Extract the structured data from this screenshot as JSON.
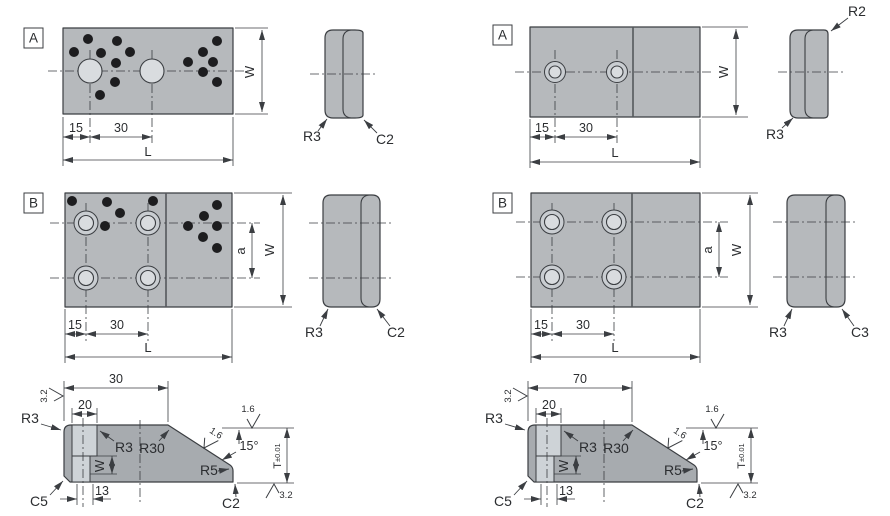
{
  "colors": {
    "paper": "#ffffff",
    "line": "#3b3e42",
    "text": "#2b2d30",
    "plate": "#b6b9bc",
    "profile": "#a7abaf",
    "slot": "#ced3d7",
    "hole": "#d9dcdf",
    "ring": "#c9cdd1",
    "dot": "#1d1d1f",
    "divider": "#55585c"
  },
  "figures": {
    "a_left": {
      "label": "A",
      "dims": {
        "d15": "15",
        "d30": "30",
        "L": "L",
        "W": "W"
      },
      "side": {
        "r3": "R3",
        "c2": "C2"
      },
      "dots": [
        [
          88,
          39
        ],
        [
          117,
          41
        ],
        [
          74,
          52
        ],
        [
          101,
          53
        ],
        [
          130,
          52
        ],
        [
          116,
          63
        ],
        [
          115,
          82
        ],
        [
          100,
          95
        ],
        [
          217,
          41
        ],
        [
          203,
          52
        ],
        [
          188,
          62
        ],
        [
          213,
          62
        ],
        [
          203,
          72
        ],
        [
          217,
          82
        ]
      ]
    },
    "a_right": {
      "label": "A",
      "dims": {
        "d15": "15",
        "d30": "30",
        "L": "L",
        "W": "W"
      },
      "side": {
        "r2": "R2",
        "r3": "R3"
      }
    },
    "b_left": {
      "label": "B",
      "dims": {
        "d15": "15",
        "d30": "30",
        "L": "L",
        "W": "W",
        "a": "a"
      },
      "side": {
        "r3": "R3",
        "c2": "C2"
      },
      "dots": [
        [
          72,
          201
        ],
        [
          107,
          202
        ],
        [
          153,
          201
        ],
        [
          120,
          213
        ],
        [
          105,
          226
        ],
        [
          217,
          205
        ],
        [
          204,
          216
        ],
        [
          188,
          226
        ],
        [
          217,
          226
        ],
        [
          203,
          237
        ],
        [
          217,
          248
        ]
      ]
    },
    "b_right": {
      "label": "B",
      "dims": {
        "d15": "15",
        "d30": "30",
        "L": "L",
        "W": "W",
        "a": "a"
      },
      "side": {
        "r3": "R3",
        "c3": "C3"
      }
    },
    "c_left": {
      "dims": {
        "top": "30",
        "d20": "20",
        "d13": "13",
        "W": "W",
        "T": "T",
        "tol": "±0.01",
        "angle": "15°"
      },
      "callouts": {
        "r3_outer": "R3",
        "r3_inner": "R3",
        "r30": "R30",
        "r5": "R5",
        "c2": "C2",
        "c5": "C5"
      },
      "finish": {
        "f32_top": "3.2",
        "f16_top": "1.6",
        "f16_slope": "1.6",
        "f32_bot": "3.2"
      }
    },
    "c_right": {
      "dims": {
        "top": "70",
        "d20": "20",
        "d13": "13",
        "W": "W",
        "T": "T",
        "tol": "±0.01",
        "angle": "15°"
      },
      "callouts": {
        "r3_outer": "R3",
        "r3_inner": "R3",
        "r30": "R30",
        "r5": "R5",
        "c2": "C2",
        "c5": "C5"
      },
      "finish": {
        "f32_top": "3.2",
        "f16_top": "1.6",
        "f16_slope": "1.6",
        "f32_bot": "3.2"
      }
    }
  }
}
